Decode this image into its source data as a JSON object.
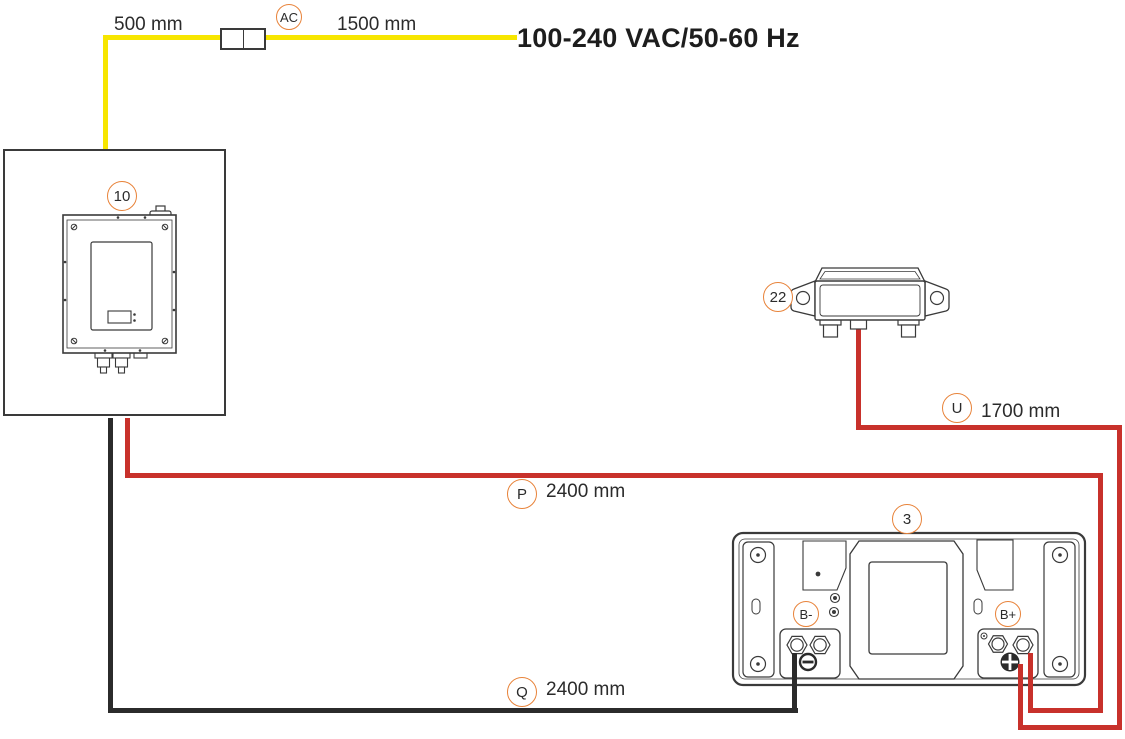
{
  "power_rating": "100-240 VAC/50-60 Hz",
  "cables": {
    "ac_input_segment": {
      "length": "500 mm"
    },
    "ac_cable": {
      "callout": "AC",
      "length": "1500 mm",
      "color": "#f7e600"
    },
    "u_cable": {
      "callout": "U",
      "length": "1700 mm",
      "color": "#c8312b"
    },
    "p_cable": {
      "callout": "P",
      "length": "2400 mm",
      "color": "#c8312b"
    },
    "q_cable": {
      "callout": "Q",
      "length": "2400 mm",
      "color": "#2b2b2b"
    }
  },
  "components": {
    "charger": {
      "callout": "10"
    },
    "interface_module": {
      "callout": "22"
    },
    "battery": {
      "callout": "3",
      "negative_terminal_label": "B-",
      "positive_terminal_label": "B+"
    }
  },
  "colors": {
    "ac_wire": "#f7e600",
    "positive_wire": "#c8312b",
    "negative_wire": "#2b2b2b",
    "callout_ring": "#e8833a",
    "line_art": "#3a3a3a",
    "text": "#2b2b2b"
  }
}
